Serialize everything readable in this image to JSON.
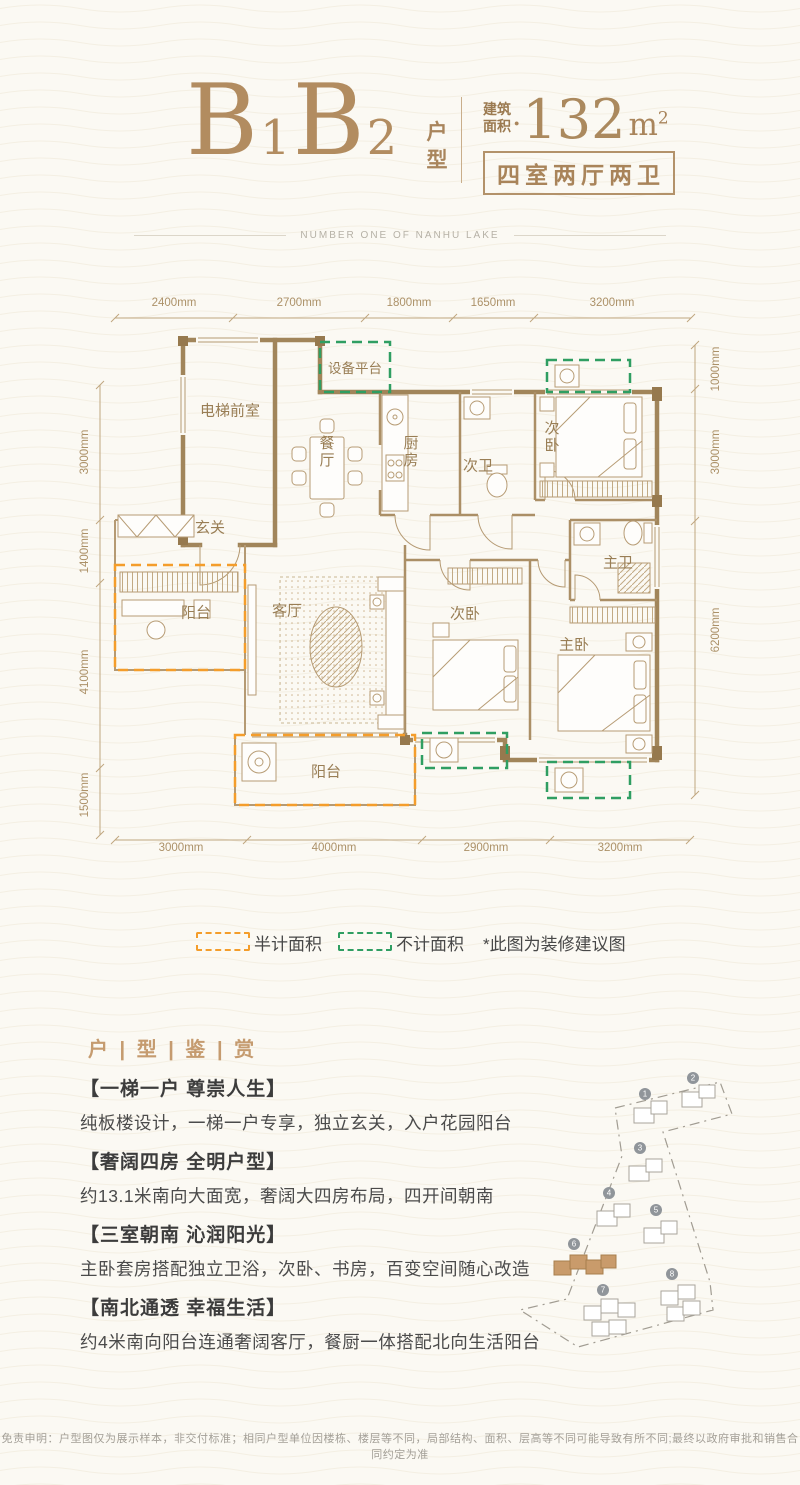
{
  "colors": {
    "accent": "#B28C60",
    "wall": "#A1855A",
    "text_dark": "#3C3C3C"
  },
  "header": {
    "name_parts": [
      "B",
      "1",
      "B",
      "2"
    ],
    "type_vertical": "户型",
    "area_label_l1": "建筑",
    "area_label_l2": "面积",
    "area_dot": "●",
    "area_value": "132",
    "area_unit": "m",
    "area_exp": "2",
    "layout": "四室两厅两卫",
    "tagline": "NUMBER ONE OF NANHU LAKE"
  },
  "floorplan": {
    "dims_top": [
      "2400mm",
      "2700mm",
      "1800mm",
      "1650mm",
      "3200mm"
    ],
    "dims_bottom": [
      "3000mm",
      "4000mm",
      "2900mm",
      "3200mm"
    ],
    "dims_left": [
      "3000mm",
      "1400mm",
      "4100mm",
      "1500mm"
    ],
    "dims_right": [
      "1000mm",
      "3000mm",
      "6200mm"
    ],
    "rooms": {
      "elevator_lobby": "电梯前室",
      "equipment_platform": "设备平台",
      "dining": "餐厅",
      "kitchen": "厨房",
      "bath2": "次卫",
      "bedroom2": "次卧",
      "foyer": "玄关",
      "balcony_entry": "阳台",
      "living": "客厅",
      "bedroom3": "次卧",
      "master_bath": "主卫",
      "master_bedroom": "主卧",
      "balcony_south": "阳台"
    }
  },
  "legend": {
    "half": "半计面积",
    "excluded": "不计面积",
    "note": "*此图为装修建议图",
    "half_color": "#F49D2B",
    "excluded_color": "#2F9E62"
  },
  "section_title": "户 | 型 | 鉴 | 赏",
  "features": [
    {
      "title": "【一梯一户 尊崇人生】",
      "body": "纯板楼设计，一梯一户专享，独立玄关，入户花园阳台"
    },
    {
      "title": "【奢阔四房 全明户型】",
      "body": "约13.1米南向大面宽，奢阔大四房布局，四开间朝南"
    },
    {
      "title": "【三室朝南 沁润阳光】",
      "body": "主卧套房搭配独立卫浴，次卧、书房，百变空间随心改造"
    },
    {
      "title": "【南北通透 幸福生活】",
      "body": "约4米南向阳台连通奢阔客厅，餐厨一体搭配北向生活阳台"
    }
  ],
  "siteplan": {
    "buildings": [
      {
        "label": "1"
      },
      {
        "label": "2"
      },
      {
        "label": "3"
      },
      {
        "label": "4"
      },
      {
        "label": "5"
      },
      {
        "label": "6"
      },
      {
        "label": "7"
      },
      {
        "label": "8"
      }
    ],
    "highlighted_building": "6"
  },
  "footer": {
    "disclaimer": "免责申明：户型图仅为展示样本，非交付标准；相同户型单位因楼栋、楼层等不同，局部结构、面积、层高等不同可能导致有所不同;最终以政府审批和销售合同约定为准"
  }
}
